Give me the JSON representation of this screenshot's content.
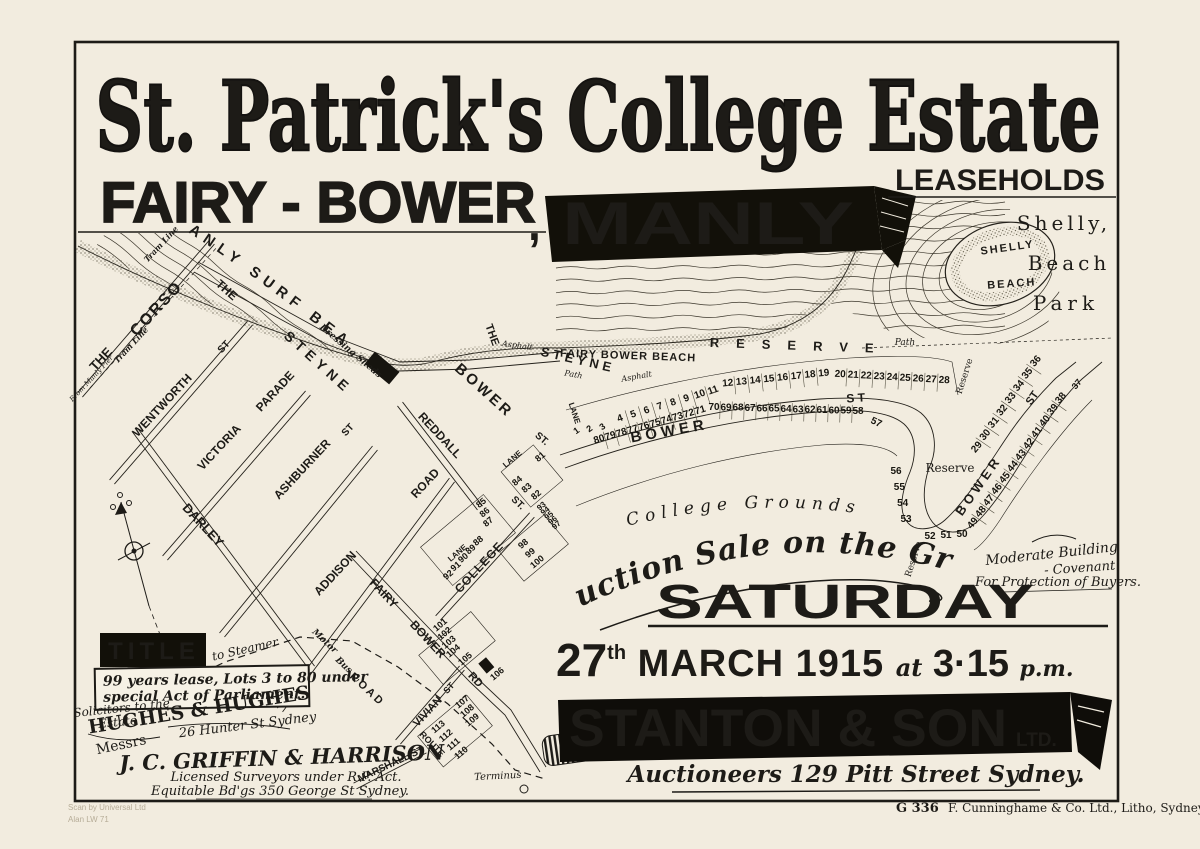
{
  "colors": {
    "paper": "#f2ecdf",
    "ink": "#1d1b17"
  },
  "poster": {
    "title": "St. Patrick's College Estate",
    "subtitle": "FAIRY - BOWER",
    "comma": ",",
    "banner": "MANLY",
    "leaseholds": "LEASEHOLDS",
    "park_line1": "Shelly,",
    "park_line2": "Beach",
    "park_line3": "Park"
  },
  "auction": {
    "arc": "For Auction Sale on the Ground",
    "day": "SATURDAY",
    "date_num": "27",
    "date_suffix": "th",
    "date_rest": " MARCH 1915 ",
    "at_word": "at",
    "time": " 3·15 ",
    "pm": "p.m.",
    "firm": "STANTON & SON",
    "firm_suffix": "LTD.",
    "firm_sub": "Auctioneers 129 Pitt Street Sydney."
  },
  "title_box": {
    "heading": "TITLE",
    "line1": "99 years lease, Lots 3 to 80 under",
    "line2": "special Act of Parliament."
  },
  "solicitors": {
    "line1": "Solicitors to the",
    "line2": "Estate",
    "messrs": "Messrs",
    "name": "HUGHES & HUGHES",
    "address": "26 Hunter St Sydney"
  },
  "surveyors": {
    "name": "J. C. GRIFFIN & HARRISON",
    "services": "Licensed Surveyors under R.P. Act.",
    "address": "Equitable Bd'gs 350 George St Sydney."
  },
  "covenant": {
    "line1": "Moderate Building",
    "line2": "- Covenant",
    "line3": "For Protection of Buyers."
  },
  "college_grounds": "( College  Grounds )",
  "footer": {
    "plate": "G 336",
    "printer": "F. Cunninghame & Co. Ltd., Litho, Sydney",
    "scan_line1": "Scan by Universal Ltd",
    "scan_line2": "Alan LW 71"
  },
  "map": {
    "labels": {
      "manly_surf_beach": "MANLY SURF BEACH",
      "fairy_bower_beach": "FAIRY BOWER BEACH",
      "shelly1": "SHELLY",
      "shelly2": "BEACH",
      "reserve_spread": "RESERVE",
      "reserve1": "Reserve",
      "reserve2": "Reserve",
      "reserve3": "Reserve",
      "path1": "Path",
      "path2": "Path",
      "asphalt1": "Asphalt",
      "asphalt2": "Asphalt",
      "the_corso_the": "THE",
      "the_corso": "CORSO",
      "tram_line1": "Tram Line",
      "tram_line2": "Tram Line",
      "from_manly_pier": "From Manly Pier",
      "wentworth": "WENTWORTH",
      "wentworth_st": "ST",
      "victoria": "VICTORIA",
      "parade": "PARADE",
      "ashburner": "ASHBURNER",
      "ashburner_st": "ST",
      "addison": "ADDISON",
      "addison_road": "ROAD",
      "darley": "DARLEY",
      "reddall": "REDDALL",
      "st1": "ST.",
      "st2": "ST.",
      "steyne_the": "THE",
      "steyne": "STEYNE",
      "steyne_the2": "THE",
      "steyne2": "STEYNE",
      "dressing_sheds": "Dressing Sheds",
      "bower_v": "BOWER",
      "bower_v_st": "ST",
      "bower_main": "B O W E R",
      "bower_main_st": "S T",
      "bower_ridge": "BOWER",
      "bower_ridge_st": "ST",
      "college": "COLLEGE",
      "lane1": "LANE",
      "lane2": "LANE",
      "lane3": "LANE",
      "fairy": "FAIRY",
      "bower_rd": "BOWER",
      "rd": "RD",
      "vivian": "VIVIAN",
      "vivian_st": "ST",
      "marshall": "MARSHALL ST",
      "motor": "Motor",
      "bus": "Bus",
      "road_d": "R O A D",
      "route": "ROUTE",
      "to_steamer": "to Steamer",
      "terminus": "Terminus"
    },
    "lots": {
      "n1": [
        "1",
        "2",
        "3"
      ],
      "n2": [
        "4",
        "5",
        "6",
        "7",
        "8",
        "9",
        "10",
        "11"
      ],
      "n3": [
        "12",
        "13",
        "14",
        "15",
        "16",
        "17",
        "18",
        "19"
      ],
      "n4": [
        "20",
        "21",
        "22",
        "23",
        "24",
        "25",
        "26",
        "27",
        "28"
      ],
      "s1": [
        "80",
        "79",
        "78",
        "77",
        "76",
        "75",
        "74",
        "73",
        "72",
        "71"
      ],
      "s2": [
        "70",
        "69",
        "68",
        "67",
        "66",
        "65",
        "64",
        "63",
        "62",
        "61",
        "60",
        "59",
        "58"
      ],
      "s3": [
        "57"
      ],
      "h1": [
        "56",
        "55",
        "54",
        "53"
      ],
      "h2": [
        "52",
        "51",
        "50"
      ],
      "r1": [
        "29",
        "30",
        "31",
        "32",
        "33",
        "34",
        "35",
        "36"
      ],
      "r2": [
        "37"
      ],
      "r3": [
        "38",
        "39",
        "40",
        "41",
        "42",
        "43",
        "44",
        "45",
        "46",
        "47",
        "48",
        "49"
      ],
      "e1": [
        "81"
      ],
      "e2": [
        "84",
        "83",
        "82"
      ],
      "a1": [
        "85",
        "86",
        "87"
      ],
      "a2": [
        "88",
        "89",
        "90",
        "91",
        "92"
      ],
      "b0": [
        "97",
        "96",
        "95",
        "94",
        "93"
      ],
      "b1": [
        "98",
        "99",
        "100"
      ],
      "c1": [
        "101",
        "102",
        "103",
        "104"
      ],
      "c2": [
        "105",
        "106"
      ],
      "d1": [
        "107",
        "108",
        "109"
      ],
      "d2": [
        "113",
        "112",
        "111",
        "110"
      ]
    }
  }
}
